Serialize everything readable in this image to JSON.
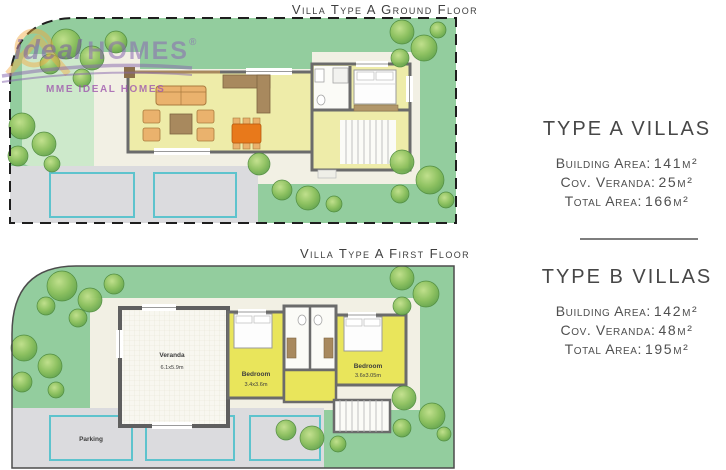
{
  "watermark": {
    "brand_script": "ideal",
    "brand_caps": "HOMES",
    "registered": "®",
    "tagline": "MME IDEAL HOMES"
  },
  "plans": {
    "ground": {
      "title": "Villa Type A Ground Floor"
    },
    "first": {
      "title": "Villa Type A First Floor",
      "rooms": {
        "veranda": {
          "name": "Veranda",
          "dims": "6.1x5.9m"
        },
        "bedroom1": {
          "name": "Bedroom",
          "dims": "3.4x3.6m"
        },
        "bedroom2": {
          "name": "Bedroom",
          "dims": "3.6x3.05m"
        }
      },
      "parking": {
        "label": "Parking"
      }
    }
  },
  "info_panels": [
    {
      "title": "TYPE A VILLAS",
      "rows": [
        {
          "label": "Building Area:",
          "value": "141m²"
        },
        {
          "label": "Cov. Veranda:",
          "value": "25m²"
        },
        {
          "label": "Total Area:",
          "value": "166m²"
        }
      ]
    },
    {
      "title": "TYPE B VILLAS",
      "rows": [
        {
          "label": "Building Area:",
          "value": "142m²"
        },
        {
          "label": "Cov. Veranda:",
          "value": "48m²"
        },
        {
          "label": "Total Area:",
          "value": "195m²"
        }
      ]
    }
  ],
  "colors": {
    "lawn": "#93cd9e",
    "lawn_light": "#cde9cb",
    "patio": "#f2f0e4",
    "floor_yellow_ground": "#eeeca9",
    "floor_yellow_first": "#e9e55b",
    "wall_gray": "#6b6b6b",
    "wood_brown": "#a8895e",
    "furniture_orange": "#eab26d",
    "table_orange": "#e8791b",
    "driveway_gray": "#dbdbde",
    "parking_teal": "#5ec3cd",
    "watermark_purple": "#8a68b2",
    "watermark_orange": "#f3a73c",
    "text_gray": "#4a4a4a"
  }
}
